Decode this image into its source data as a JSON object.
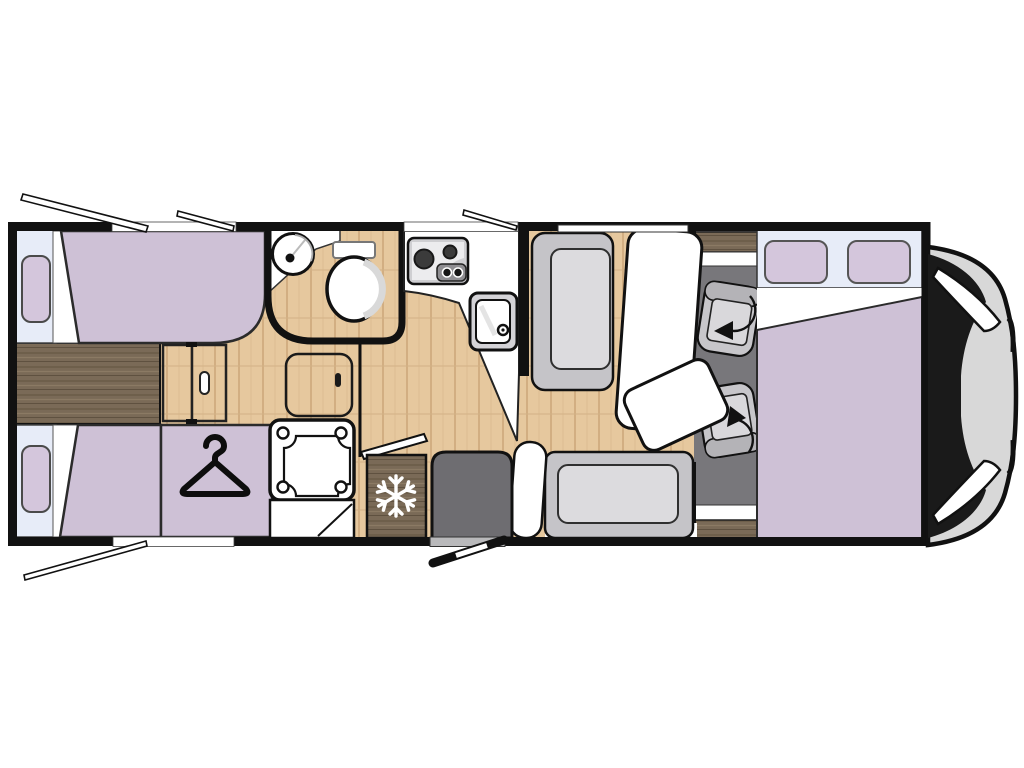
{
  "title": "motorhome-floor-plan",
  "colors": {
    "wall": "#111111",
    "interior": "#ffffff",
    "wood_light": "#e6c89e",
    "wood_light_line": "#cda87a",
    "wood_dark": "#7a6a57",
    "wood_dark_line1": "#695b47",
    "wood_dark_line2": "#8b7a64",
    "mattress": "#cec1d6",
    "pillow": "#d4c6dc",
    "headboard": "#e7ecf8",
    "cab_floor": "#78777b",
    "seat_base": "#c7c6ca",
    "seat_cushion": "#d9d8db",
    "bench": "#c5c4c8",
    "bench_cushion": "#dcdbde",
    "step_dark": "#6e6d71",
    "table": "#ffffff",
    "shower": "#ffffff",
    "cab_body": "#d8d8d8",
    "windshield": "#1a1a1a",
    "appliance_gray": "#cfcfd2",
    "appliance_inner": "#ececee",
    "sink_gray": "#d4d3d7",
    "knob_panel": "#8f8e92",
    "burner": "#3b3b3b",
    "icon_black": "#0d0d0d",
    "icon_white": "#ffffff",
    "door_sill": "#b9b9bb"
  },
  "icons": {
    "snowflake": "snowflake-icon (refrigerator)",
    "hanger": "hanger-icon (wardrobe)",
    "swivel_arrow": "swivel-arrow-icon (rotating cab seat)",
    "burners": "hob-burners-icon (2-ring gas hob)",
    "basin": "round-washbasin-icon",
    "toilet": "toilet-icon"
  },
  "elements": {
    "rear_bed_top": "single bed with pillow",
    "rear_bed_bottom": "single bed with pillow",
    "walkway": "dark wood step between rear beds",
    "sliding_door": "bedroom sliding partition with handle",
    "wardrobe": "wardrobe with hanger symbol",
    "bathroom": "washroom with round basin and toilet",
    "shower": "shower cubicle with tray",
    "kitchen": "kitchen block with 2-burner hob and sink",
    "fridge": "refrigerator with snowflake symbol",
    "dinette": "bench seats with table",
    "cab_seats": "two swivelling cab seats with rotation arrows",
    "front_bed": "front double bed with two pillows",
    "entry_door": "open entry door (bottom)",
    "windows_open": "5 opened window flaps shown outside the walls",
    "cab": "vehicle cab nose with windscreen"
  }
}
